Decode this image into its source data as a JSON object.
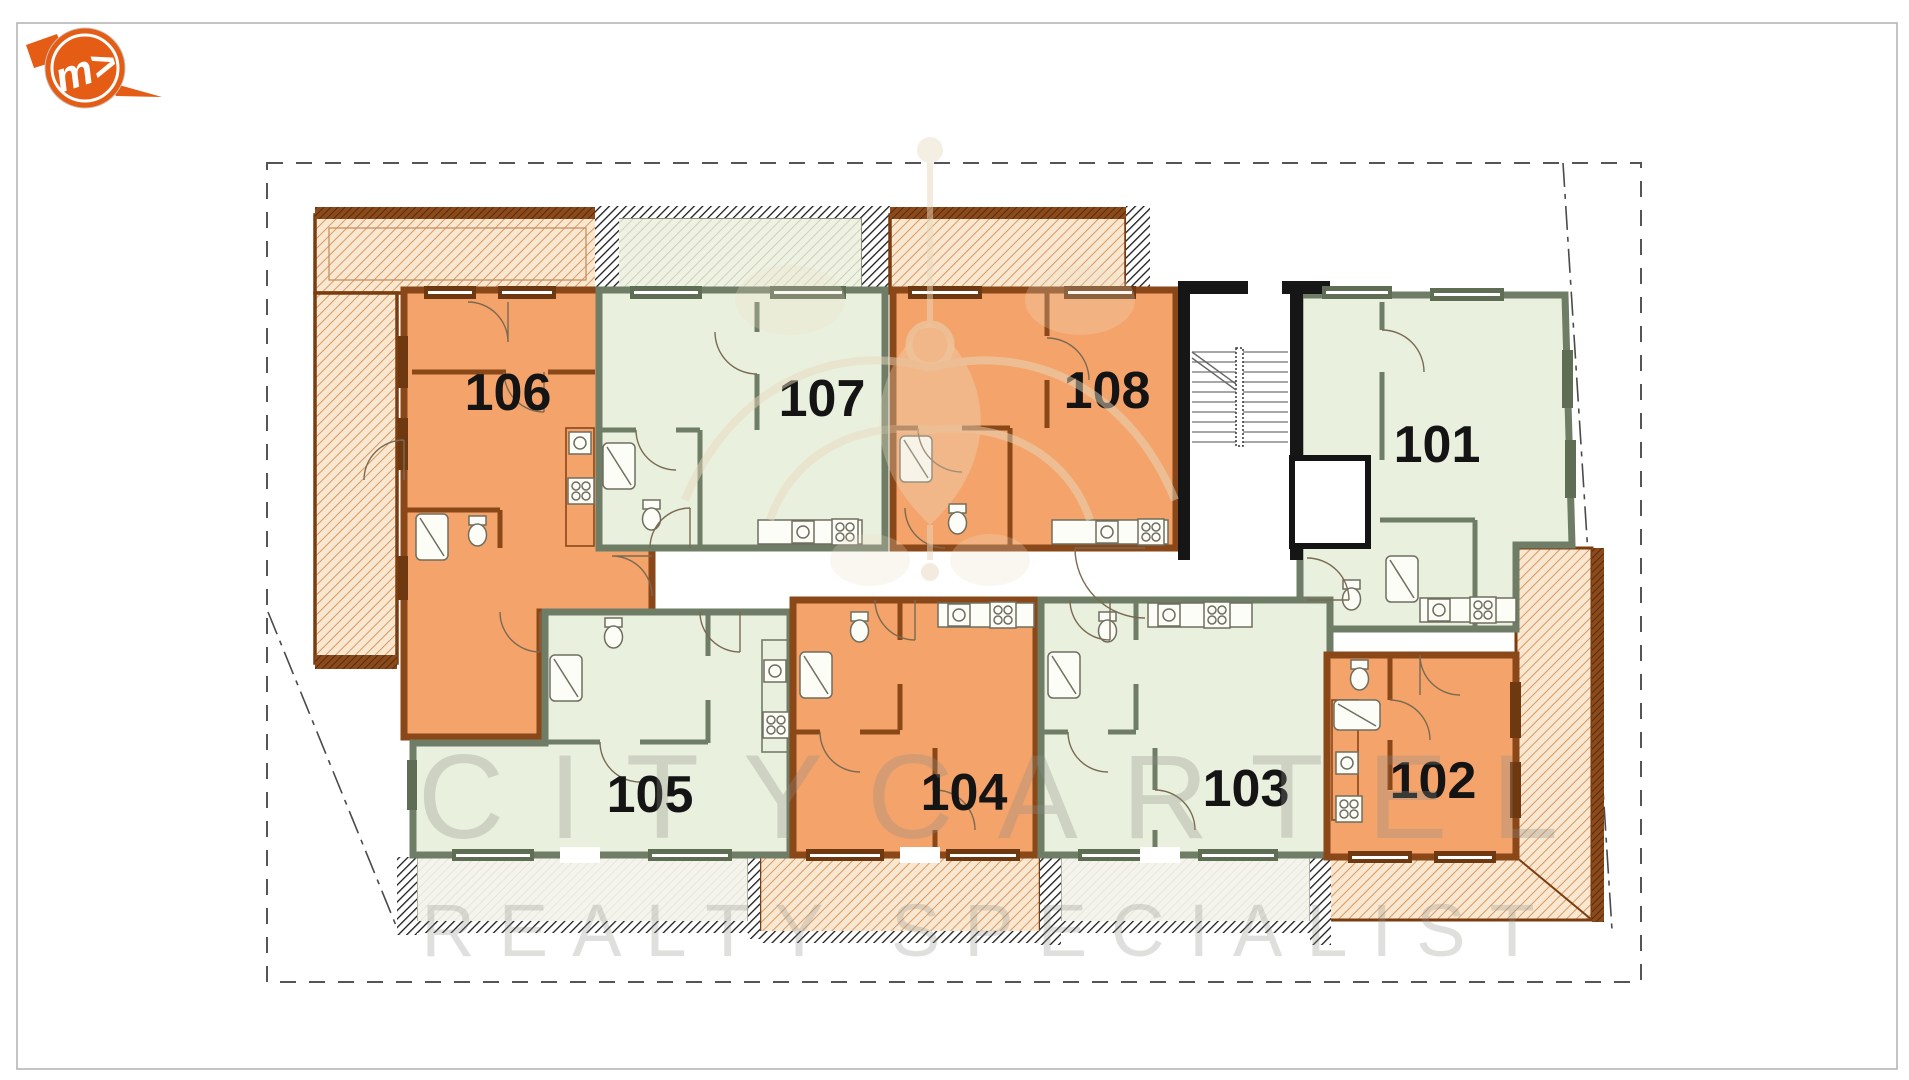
{
  "logo": {
    "monogram": "m>",
    "color": "#e55c15"
  },
  "watermark": {
    "line1": "CITYCARTEL",
    "line2": "REALTY SPECIALIST"
  },
  "plan": {
    "units": [
      {
        "label": "101",
        "palette": "green"
      },
      {
        "label": "102",
        "palette": "orange"
      },
      {
        "label": "103",
        "palette": "green"
      },
      {
        "label": "104",
        "palette": "orange"
      },
      {
        "label": "105",
        "palette": "green"
      },
      {
        "label": "106",
        "palette": "orange"
      },
      {
        "label": "107",
        "palette": "green"
      },
      {
        "label": "108",
        "palette": "orange"
      }
    ],
    "colors": {
      "unit_orange": "#f4a36a",
      "unit_green": "#eaf0de",
      "wall_orange": "#8a4718",
      "wall_green": "#6f7d66",
      "terrace_line": "#d2915c",
      "terrace_border": "#7b3c10",
      "boundary": "#555555",
      "stair_wall": "#161616"
    }
  }
}
